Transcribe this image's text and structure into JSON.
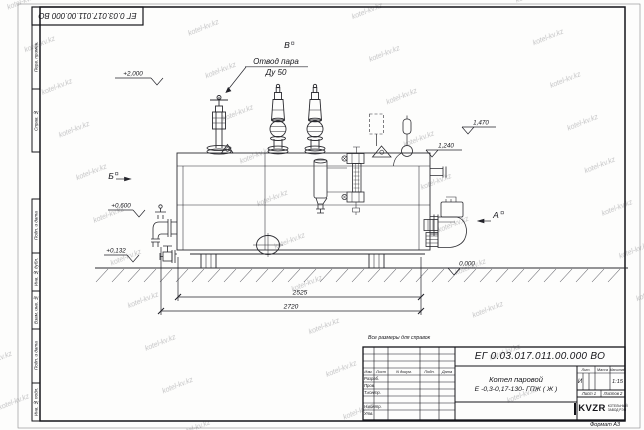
{
  "sheet": {
    "format_label": "Формат А3",
    "reference_note": "Все размеры для справок",
    "watermark": "kotel-kv.kz"
  },
  "border_stamps": {
    "perv_primen": "Перв. примен.",
    "sprav_no": "Справ. №",
    "podp_data_1": "Подп. и дата",
    "inv_dubl": "Инв. № дубл.",
    "vzam_inv": "Взам. инв. №",
    "podp_data_2": "Подп. и дата",
    "inv_podl": "Инв. № подл."
  },
  "drawing": {
    "steam_outlet_label_1": "Отвод пара",
    "steam_outlet_label_2": "Ду 50",
    "view_a": "А",
    "view_b": "Б",
    "view_v": "В",
    "elev_2000": "+2,000",
    "elev_1470": "1,470",
    "elev_1240": "1,240",
    "elev_0600": "+0,600",
    "elev_0132": "+0,132",
    "elev_0000": "0,000",
    "dim_inner": "2525",
    "dim_overall": "2720"
  },
  "title_block": {
    "designation": "ЕГ 0.03.017.011.00.000 ВО",
    "product_line_1": "Котел паровой",
    "product_line_2": "Е -0,3-0,17-130- ГПЖ ( Ж )",
    "col_izm": "Изм.",
    "col_list": "Лист",
    "col_dokum": "N докум.",
    "col_podp": "Подп.",
    "col_data": "Дата",
    "row_razrab": "Разраб.",
    "row_prov": "Пров.",
    "row_tkontr": "Т.контр.",
    "row_nkontr": "Н.контр.",
    "row_utv": "Утв.",
    "lit_header": "Лит.",
    "massa_header": "Масса",
    "masshtab_header": "Масштаб",
    "litera": "И",
    "scale": "1:15",
    "sheet_label": "Лист 1",
    "sheets_label": "Листов 2",
    "logo_text": "KVZR",
    "logo_sub_1": "КОТЕЛЬНЫЙ",
    "logo_sub_2": "ЗАВОД РЭП"
  }
}
